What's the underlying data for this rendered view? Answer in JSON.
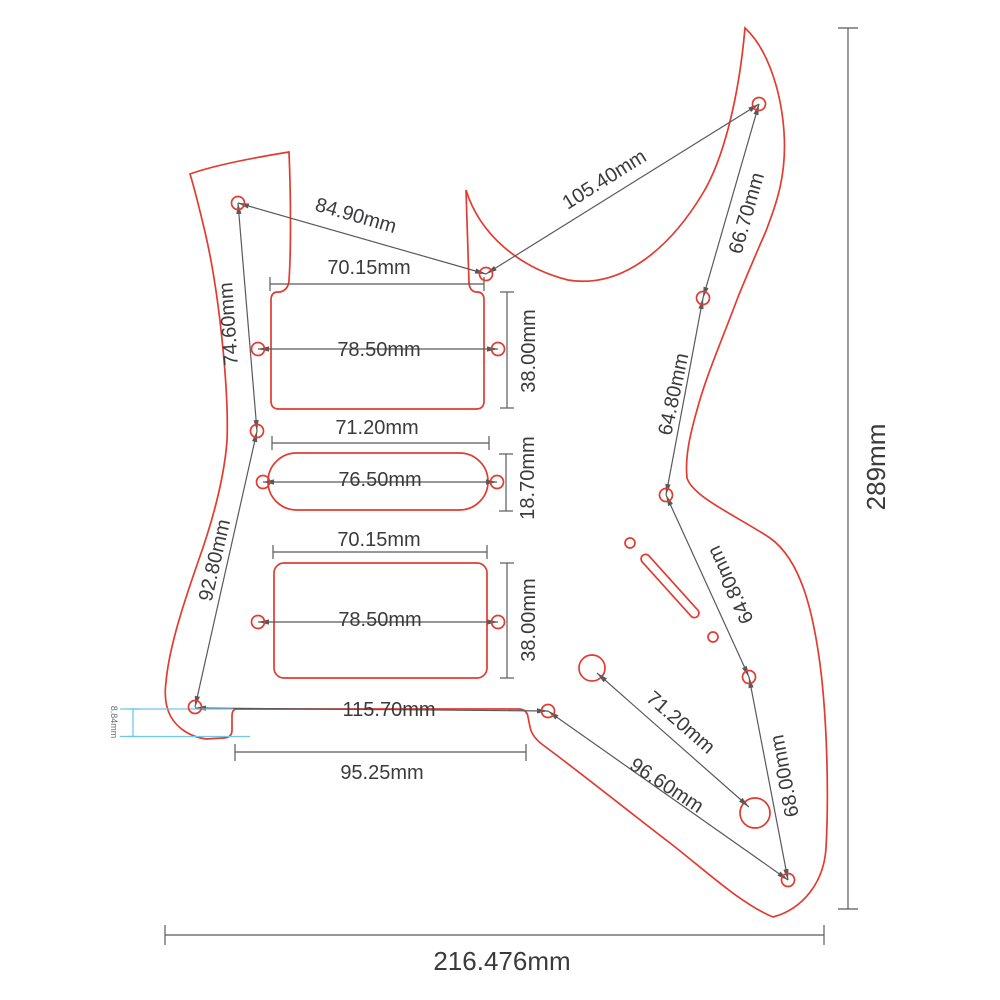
{
  "figure": {
    "kind": "pickguard-dimension-drawing",
    "unit": "mm"
  },
  "colors": {
    "outline_red": "#e23b30",
    "dimension_gray": "#59595b",
    "step_highlight_cyan": "#6fc8e8",
    "text": "#3b3b3d",
    "background": "#ffffff"
  },
  "overall": {
    "height": "289mm",
    "width": "216.476mm"
  },
  "dims": {
    "horn_to_center": "84.90mm",
    "center_to_upper_horn": "105.40mm",
    "upper_horn_edge": "66.70mm",
    "left_upper_vertical": "74.60mm",
    "left_lower_diagonal": "92.80mm",
    "neck_cutout_width": "70.15mm",
    "neck_screw_span": "78.50mm",
    "neck_cutout_height": "38.00mm",
    "single_cutout_width": "71.20mm",
    "single_screw_span": "76.50mm",
    "single_cutout_height": "18.70mm",
    "bridge_cutout_width": "70.15mm",
    "bridge_screw_span": "78.50mm",
    "bridge_cutout_height": "38.00mm",
    "bottom_screw_span": "115.70mm",
    "bridge_edge_width": "95.25mm",
    "edge_step": "8.84mm",
    "pot_span": "71.20mm",
    "bottom_diagonal": "96.60mm",
    "lower_right_span": "68.00mm",
    "right_upper_span": "64.80mm",
    "right_lower_span": "64.80mm"
  }
}
